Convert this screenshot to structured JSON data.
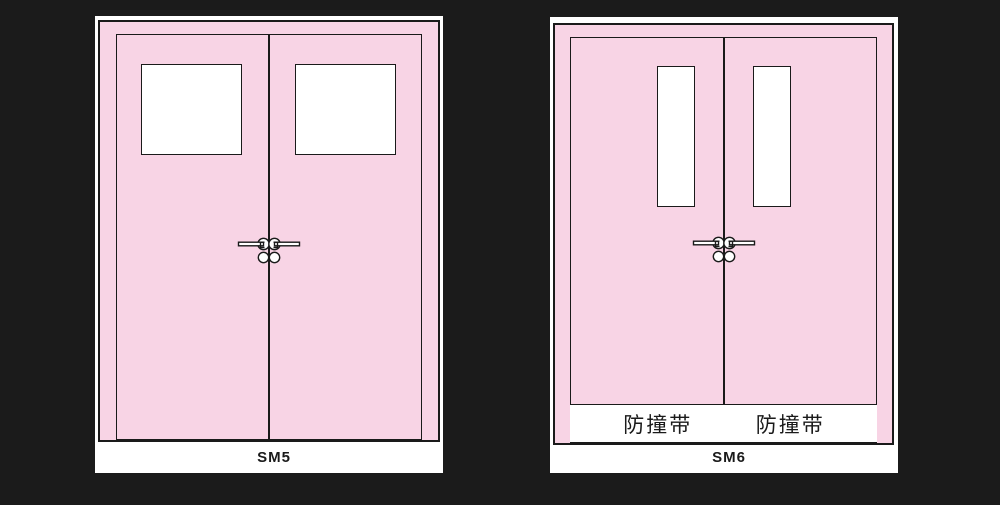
{
  "canvas": {
    "background_color": "#1b1b1b",
    "panel_background": "#ffffff",
    "door_color": "#f8d4e5",
    "line_color": "#1a1a1a",
    "glass_color": "#ffffff"
  },
  "diagrams": [
    {
      "label": "SM5",
      "bumper_strips": []
    },
    {
      "label": "SM6",
      "bumper_strips": [
        "防撞带",
        "防撞带"
      ]
    }
  ]
}
